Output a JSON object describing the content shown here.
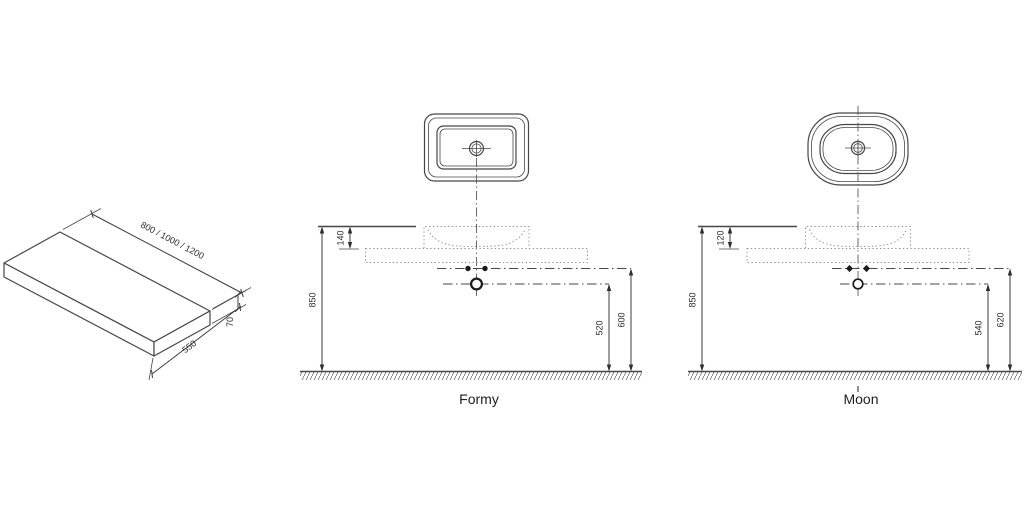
{
  "slab": {
    "length_label": "800 / 1000 / 1200",
    "depth_label": "550",
    "thickness_label": "70"
  },
  "models": {
    "formy": {
      "name": "Formy",
      "dim_basin_rim": "140",
      "dim_height": "850",
      "dim_siphon": "520",
      "dim_outlet": "600"
    },
    "moon": {
      "name": "Moon",
      "dim_basin_rim": "120",
      "dim_height": "850",
      "dim_siphon": "540",
      "dim_outlet": "620"
    }
  },
  "colors": {
    "line": "#474747",
    "dotted_line": "#949494",
    "text": "#2d2d2d",
    "background": "#ffffff"
  }
}
